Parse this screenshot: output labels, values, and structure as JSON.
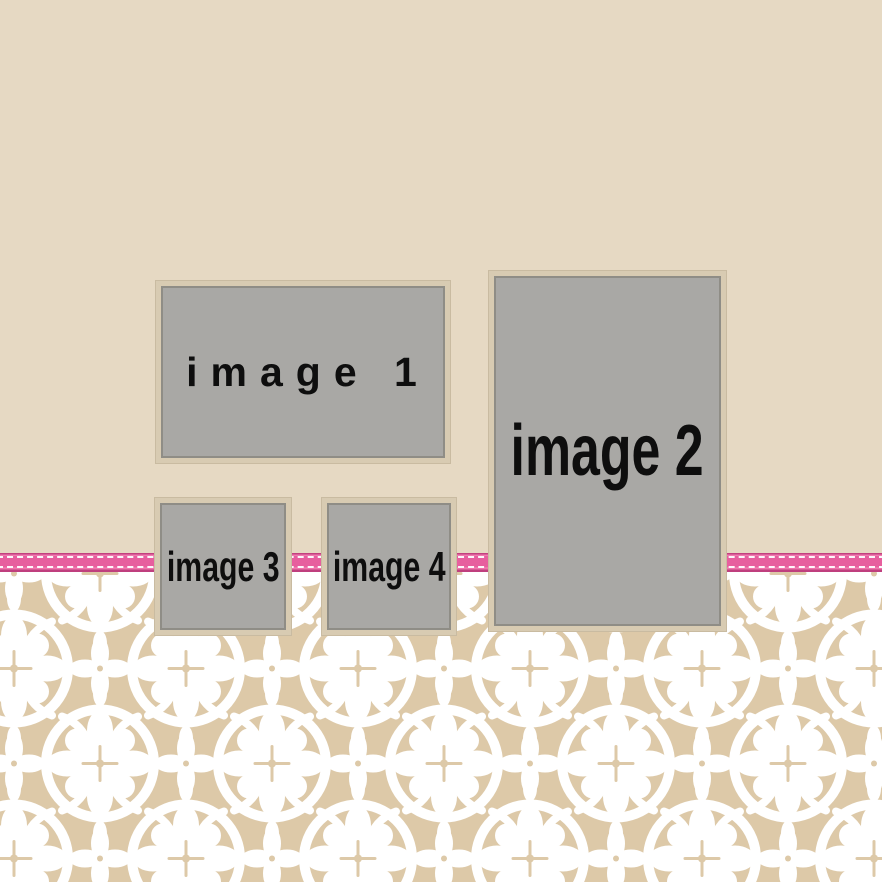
{
  "canvas": {
    "width": 882,
    "height": 882
  },
  "placeholders": [
    {
      "id": "image-1",
      "label": "image 1"
    },
    {
      "id": "image-2",
      "label": "image 2"
    },
    {
      "id": "image-3",
      "label": "image 3"
    },
    {
      "id": "image-4",
      "label": "image 4"
    }
  ],
  "decor": {
    "ribbon_name": "stitched-ribbon",
    "pattern_name": "white-floral-damask-band"
  },
  "colors": {
    "background_beige": "#e6d9c3",
    "pattern_tan": "#ddc9a8",
    "pattern_white": "#ffffff",
    "ribbon_pink": "#e75f9e",
    "ribbon_edge_dark": "#c2407f",
    "ribbon_stitch": "#ffffff",
    "placeholder_gray": "#a9a8a5",
    "placeholder_mat_tan": "#d8cbb2",
    "placeholder_inner_line": "#8f8d86",
    "label_black": "#0e0e0e"
  }
}
